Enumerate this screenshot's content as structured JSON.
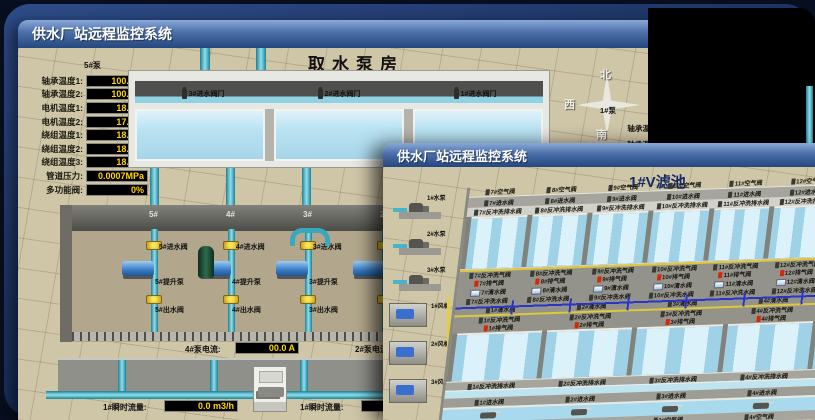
{
  "back": {
    "title": "供水厂站远程监控系统",
    "room": "取水泵房",
    "panel": {
      "title": "5#泵",
      "rows": [
        {
          "label": "轴承温度1:",
          "value": "100.0℃"
        },
        {
          "label": "轴承温度2:",
          "value": "100.0℃"
        },
        {
          "label": "电机温度1:",
          "value": "18.1℃"
        },
        {
          "label": "电机温度2:",
          "value": "17.9℃"
        },
        {
          "label": "绕组温度1:",
          "value": "18.0℃"
        },
        {
          "label": "绕组温度2:",
          "value": "18.1℃"
        },
        {
          "label": "绕组温度3:",
          "value": "18.1℃"
        },
        {
          "label": "管道压力:",
          "value": "0.0007MPa"
        },
        {
          "label": "多功能阀:",
          "value": "0%"
        }
      ]
    },
    "intake_valves": [
      "3#进水阀门",
      "2#进水阀门",
      "1#进水阀门"
    ],
    "bays": [
      {
        "no": "5#",
        "vin": "5#进水阀",
        "pump": "5#提升泵",
        "vout": "5#出水阀"
      },
      {
        "no": "4#",
        "vin": "4#进水阀",
        "pump": "4#提升泵",
        "vout": "4#出水阀"
      },
      {
        "no": "3#",
        "vin": "3#进水阀",
        "pump": "3#提升泵",
        "vout": "3#出水阀"
      },
      {
        "no": "2#",
        "vin": "2#进水阀",
        "pump": "2#提升泵",
        "vout": "2#出水阀"
      }
    ],
    "currents": [
      {
        "label": "4#泵电流:",
        "value": "00.0 A"
      },
      {
        "label": "2#泵电流:",
        "value": ""
      }
    ],
    "flows": [
      {
        "label": "1#瞬时流量:",
        "value": "0.0 m3/h"
      },
      {
        "label": "1#瞬时流量:",
        "value": "0.0 m3/h"
      }
    ],
    "compass": {
      "n": "北",
      "w": "西",
      "s": "南"
    },
    "right_panel": {
      "title": "1#泵",
      "labels": [
        "轴承温度1:",
        "轴承温度2:"
      ]
    }
  },
  "front": {
    "title": "供水厂站远程监控系统",
    "pool_title": "1#V滤池",
    "pumps": [
      "1#水泵",
      "2#水泵",
      "3#水泵"
    ],
    "blowers": [
      "1#风机",
      "2#风机",
      "3#风机"
    ],
    "rows": {
      "air_top": [
        "7#空气阀",
        "8#空气阀",
        "9#空气阀",
        "10#空气阀",
        "11#空气阀",
        "12#空气阀"
      ],
      "inlet_top": [
        "7#进水阀",
        "8#进水阀",
        "9#进水阀",
        "10#进水阀",
        "11#进水阀",
        "12#进水阀"
      ],
      "drain_top": [
        "7#反冲洗排水阀",
        "8#反冲洗排水阀",
        "9#反冲洗排水阀",
        "10#反冲洗排水阀",
        "11#反冲洗排水阀",
        "12#反冲洗排水阀"
      ],
      "bw_air_top": [
        "7#反冲洗气阀",
        "8#反冲洗气阀",
        "9#反冲洗气阀",
        "10#反冲洗气阀",
        "11#反冲洗气阀",
        "12#反冲洗气阀"
      ],
      "exhaust_top": [
        "7#排气阀",
        "8#排气阀",
        "9#排气阀",
        "10#排气阀",
        "11#排气阀",
        "12#排气阀"
      ],
      "clear_top": [
        "7#清水阀",
        "8#清水阀",
        "9#清水阀",
        "10#清水阀",
        "11#清水阀",
        "12#清水阀"
      ],
      "bw_water_top": [
        "7#反冲洗水阀",
        "8#反冲洗水阀",
        "9#反冲洗水阀",
        "10#反冲洗水阀",
        "11#反冲洗水阀",
        "12#反冲洗水阀"
      ],
      "clear_bot": [
        "1#清水阀",
        "2#清水阀",
        "3#清水阀",
        "4#清水阀",
        "5#清水阀",
        "6#清水阀"
      ],
      "bw_air_bot": [
        "1#反冲洗气阀",
        "2#反冲洗气阀",
        "3#反冲洗气阀",
        "4#反冲洗气阀",
        "5#反冲洗气阀",
        "6#反冲洗气阀"
      ],
      "exhaust_bot": [
        "1#排气阀",
        "2#排气阀",
        "3#排气阀",
        "4#排气阀",
        "5#排气阀",
        "6#排气阀"
      ],
      "drain_bot": [
        "1#反冲洗排水阀",
        "2#反冲洗排水阀",
        "3#反冲洗排水阀",
        "4#反冲洗排水阀",
        "5#反冲洗排水阀",
        "6#反冲洗排水阀"
      ],
      "inlet_bot": [
        "1#进水阀",
        "2#进水阀",
        "3#进水阀",
        "4#进水阀",
        "5#进水阀",
        "6#进水阀"
      ],
      "air_bot": [
        "1#空气阀",
        "2#空气阀",
        "3#空气阀",
        "4#空气阀",
        "5#空气阀",
        "6#空气阀"
      ]
    }
  }
}
